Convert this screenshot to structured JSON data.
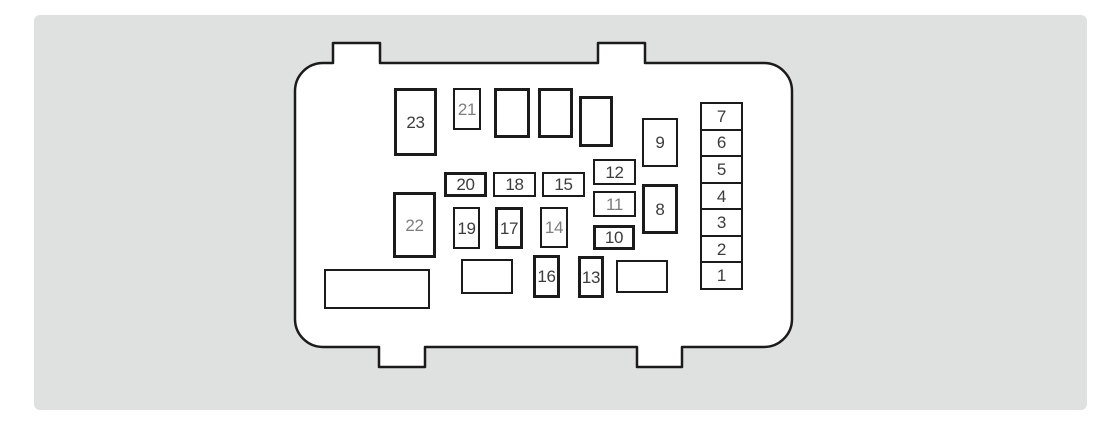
{
  "diagram": {
    "description": "Engine compartment fuse box diagram with numbered fuse positions",
    "colors": {
      "page_background": "#ffffff",
      "panel_background": "#dfe0e0",
      "line": "#1b1b1b",
      "label_dark": "#3c3c3c",
      "label_light": "#7e7e7e"
    },
    "panel": {
      "x": 34,
      "y": 15,
      "w": 1053,
      "h": 395
    },
    "shell": {
      "x": 295,
      "y": 63,
      "w": 497,
      "h": 284,
      "r": 28,
      "tab_h": 20,
      "top_tabs": [
        {
          "x": 333,
          "w": 47
        },
        {
          "x": 598,
          "w": 47
        }
      ],
      "bottom_tabs": [
        {
          "x": 379,
          "w": 46
        },
        {
          "x": 637,
          "w": 45
        }
      ]
    },
    "fuses": [
      {
        "label": "23",
        "x": 394,
        "y": 88,
        "w": 43,
        "h": 68,
        "thick": true,
        "tone": "dark"
      },
      {
        "label": "21",
        "x": 453,
        "y": 88,
        "w": 28,
        "h": 42,
        "thick": false,
        "tone": "light"
      },
      {
        "label": "",
        "x": 494,
        "y": 88,
        "w": 36,
        "h": 50,
        "thick": true,
        "tone": "dark"
      },
      {
        "label": "",
        "x": 538,
        "y": 88,
        "w": 35,
        "h": 50,
        "thick": true,
        "tone": "dark"
      },
      {
        "label": "",
        "x": 579,
        "y": 96,
        "w": 34,
        "h": 51,
        "thick": true,
        "tone": "dark"
      },
      {
        "label": "9",
        "x": 642,
        "y": 118,
        "w": 36,
        "h": 49,
        "thick": false,
        "tone": "dark"
      },
      {
        "label": "12",
        "x": 593,
        "y": 159,
        "w": 43,
        "h": 26,
        "thick": false,
        "tone": "dark"
      },
      {
        "label": "20",
        "x": 444,
        "y": 172,
        "w": 43,
        "h": 25,
        "thick": true,
        "tone": "dark"
      },
      {
        "label": "18",
        "x": 493,
        "y": 172,
        "w": 43,
        "h": 25,
        "thick": false,
        "tone": "dark"
      },
      {
        "label": "15",
        "x": 542,
        "y": 172,
        "w": 43,
        "h": 25,
        "thick": false,
        "tone": "dark"
      },
      {
        "label": "8",
        "x": 642,
        "y": 184,
        "w": 36,
        "h": 50,
        "thick": true,
        "tone": "dark"
      },
      {
        "label": "11",
        "x": 593,
        "y": 191,
        "w": 43,
        "h": 26,
        "thick": false,
        "tone": "light"
      },
      {
        "label": "22",
        "x": 393,
        "y": 192,
        "w": 43,
        "h": 66,
        "thick": true,
        "tone": "light"
      },
      {
        "label": "19",
        "x": 453,
        "y": 207,
        "w": 27,
        "h": 42,
        "thick": false,
        "tone": "dark"
      },
      {
        "label": "17",
        "x": 495,
        "y": 207,
        "w": 28,
        "h": 42,
        "thick": true,
        "tone": "dark"
      },
      {
        "label": "14",
        "x": 540,
        "y": 207,
        "w": 28,
        "h": 41,
        "thick": false,
        "tone": "light"
      },
      {
        "label": "10",
        "x": 593,
        "y": 225,
        "w": 42,
        "h": 25,
        "thick": true,
        "tone": "dark"
      },
      {
        "label": "16",
        "x": 533,
        "y": 255,
        "w": 27,
        "h": 43,
        "thick": true,
        "tone": "dark"
      },
      {
        "label": "13",
        "x": 578,
        "y": 256,
        "w": 26,
        "h": 42,
        "thick": true,
        "tone": "dark"
      },
      {
        "label": "",
        "x": 461,
        "y": 259,
        "w": 52,
        "h": 35,
        "thick": false,
        "tone": "dark"
      },
      {
        "label": "",
        "x": 616,
        "y": 260,
        "w": 52,
        "h": 33,
        "thick": false,
        "tone": "dark"
      },
      {
        "label": "",
        "x": 324,
        "y": 269,
        "w": 106,
        "h": 40,
        "thick": false,
        "tone": "dark"
      }
    ],
    "column": {
      "x": 700,
      "y": 102,
      "w": 43,
      "h": 188,
      "cells": [
        "7",
        "6",
        "5",
        "4",
        "3",
        "2",
        "1"
      ]
    }
  }
}
